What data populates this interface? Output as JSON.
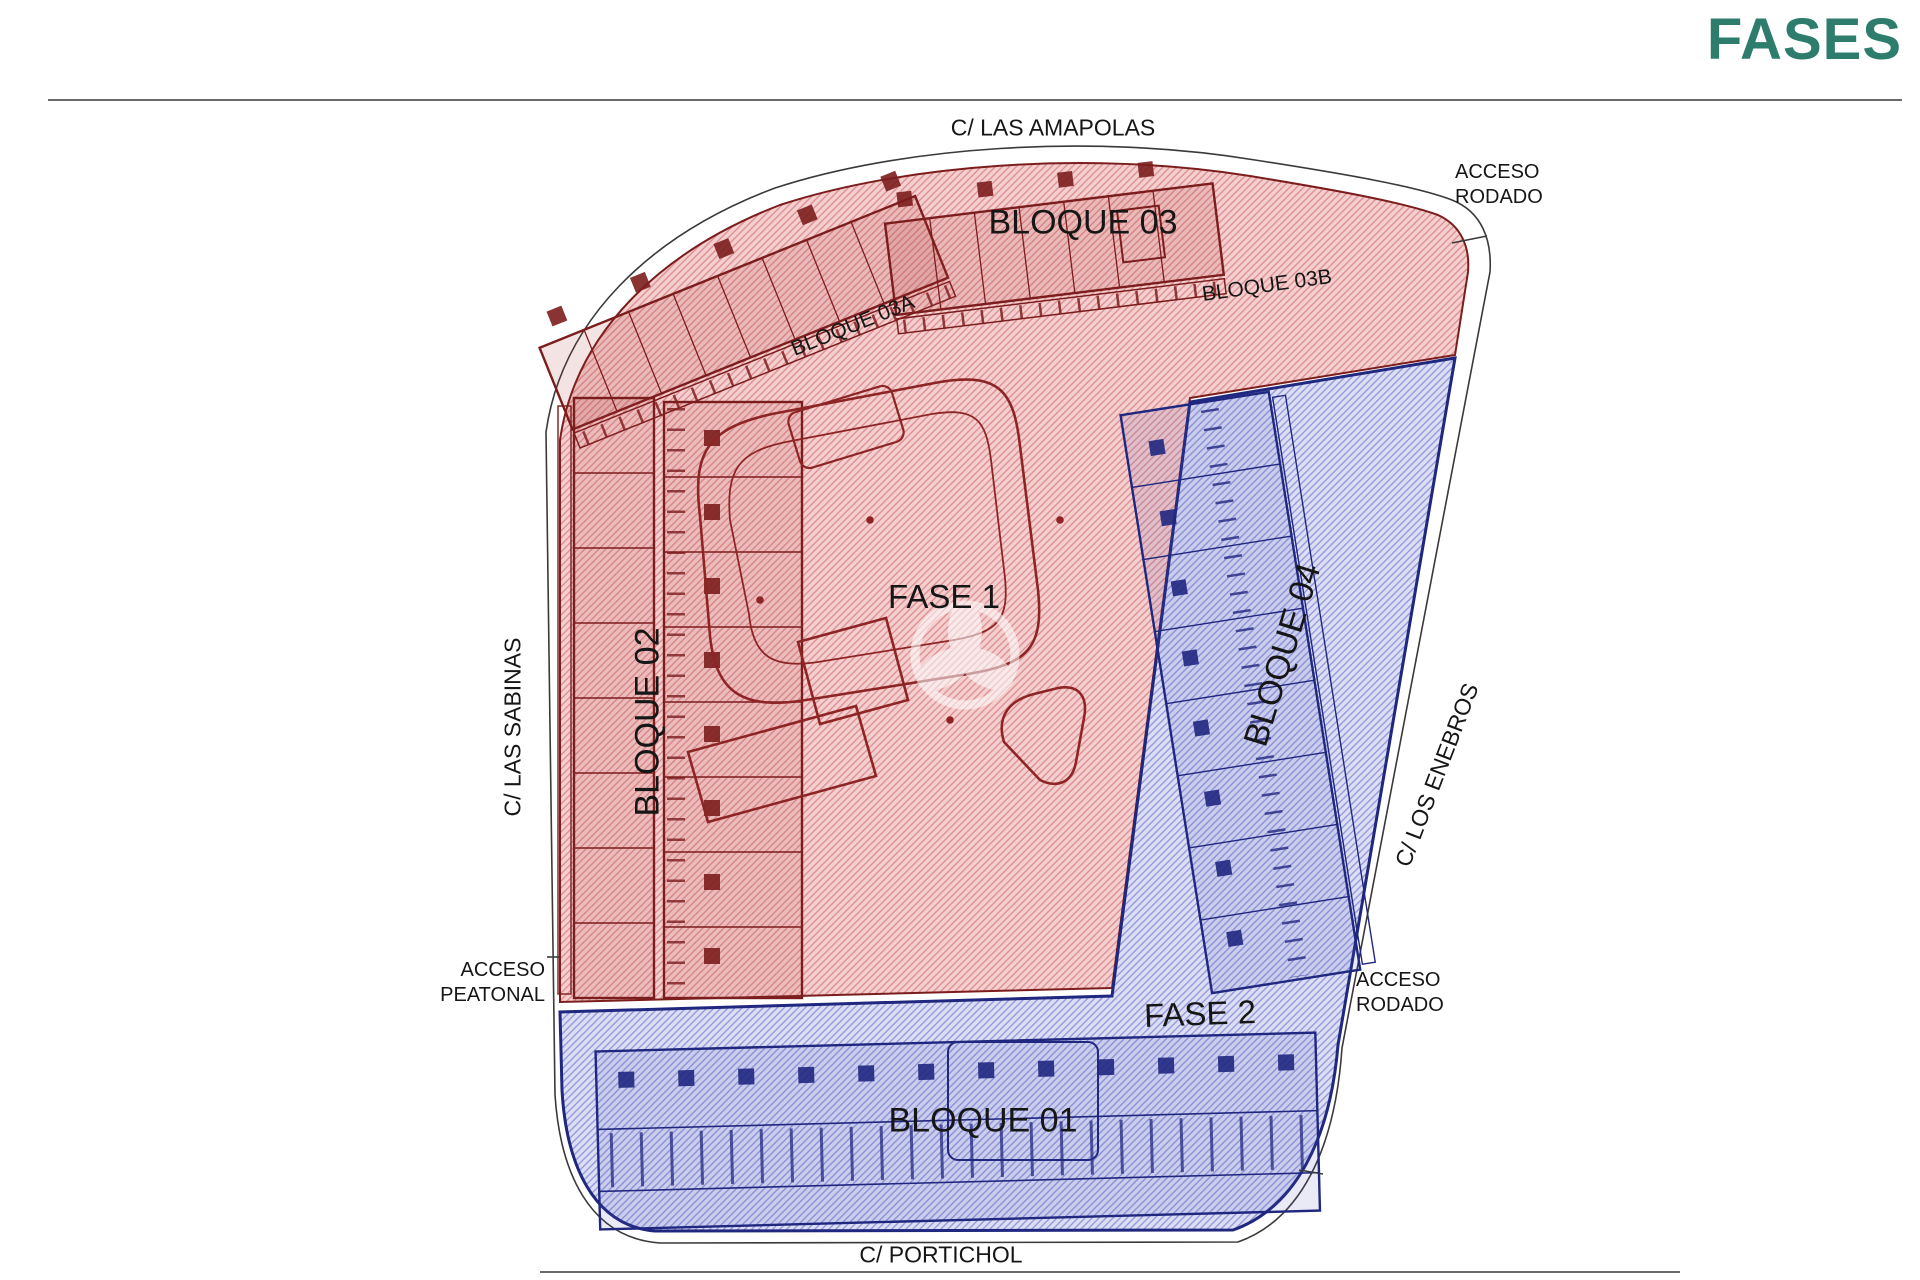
{
  "header": {
    "title": "FASES"
  },
  "colors": {
    "title_teal": "#2d7c6c",
    "phase1_fill": "#f5cfcf",
    "phase1_hatch": "#dc9192",
    "phase1_line": "#7c1d1d",
    "phase2_fill": "#dcdef4",
    "phase2_hatch": "#959ada",
    "phase2_line": "#20277f",
    "boundary": "#3a3a3a"
  },
  "plan": {
    "streets": {
      "top": "C/ LAS AMAPOLAS",
      "left": "C/ LAS SABINAS",
      "right": "C/ LOS ENEBROS",
      "bottom": "C/ PORTICHOL"
    },
    "access": {
      "top_right": {
        "l1": "ACCESO",
        "l2": "RODADO"
      },
      "left": {
        "l1": "ACCESO",
        "l2": "PEATONAL"
      },
      "right": {
        "l1": "ACCESO",
        "l2": "RODADO"
      }
    },
    "phases": {
      "fase1": "FASE 1",
      "fase2": "FASE 2"
    },
    "blocks": {
      "b01": "BLOQUE 01",
      "b02": "BLOQUE 02",
      "b03": "BLOQUE 03",
      "b03a": "BLOQUE 03A",
      "b03b": "BLOQUE 03B",
      "b04": "BLOQUE 04"
    }
  }
}
